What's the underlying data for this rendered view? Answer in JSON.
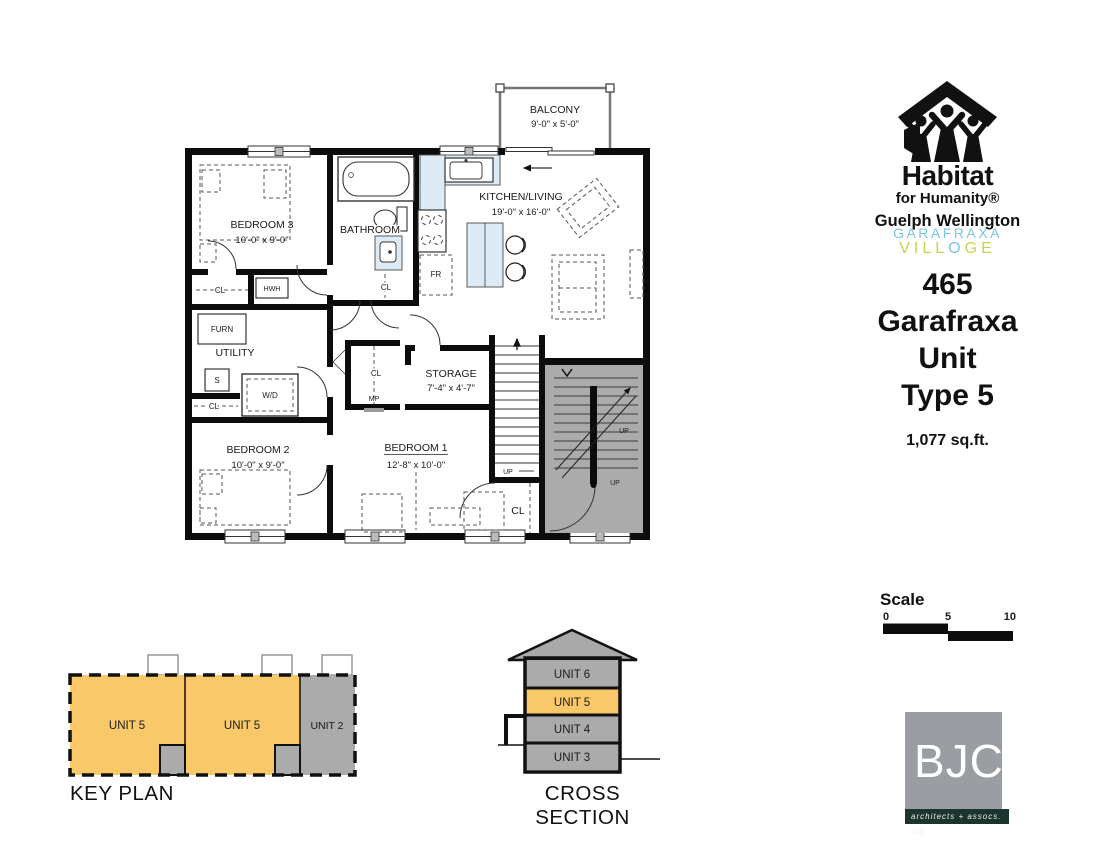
{
  "plan": {
    "balcony": {
      "name": "BALCONY",
      "dims": "9'-0\" x 5'-0\""
    },
    "kitchen": {
      "name": "KITCHEN/LIVING",
      "dims": "19'-0\" x 16'-0\""
    },
    "bathroom": {
      "name": "BATHROOM"
    },
    "bedroom3": {
      "name": "BEDROOM 3",
      "dims": "10'-0\" x 9'-0\""
    },
    "bedroom2": {
      "name": "BEDROOM 2",
      "dims": "10'-0\" x 9'-0\""
    },
    "bedroom1": {
      "name": "BEDROOM 1",
      "dims": "12'-8\" x 10'-0\""
    },
    "storage": {
      "name": "STORAGE",
      "dims": "7'-4\" x 4'-7\""
    },
    "utility": {
      "name": "UTILITY"
    },
    "labels": {
      "cl": "CL",
      "hwh": "HWH",
      "furn": "FURN",
      "s": "S",
      "wd": "W/D",
      "fr": "FR",
      "mp": "MP",
      "up": "UP"
    }
  },
  "branding": {
    "habitat": {
      "word": "Habitat",
      "sub": "for Humanity®",
      "region": "Guelph Wellington"
    },
    "village": {
      "line1": "GARAFRAXA",
      "l2a": "VILL",
      "l2o": "O",
      "l2b": "GE"
    }
  },
  "title": {
    "lines": [
      "465",
      "Garafraxa",
      "Unit",
      "Type 5"
    ],
    "area": "1,077 sq.ft."
  },
  "scale": {
    "label": "Scale",
    "t0": "0",
    "t5": "5",
    "t10": "10"
  },
  "key_plan": {
    "label": "KEY PLAN",
    "units": [
      "UNIT 5",
      "UNIT 5",
      "UNIT 2"
    ]
  },
  "cross_section": {
    "label": "CROSS SECTION",
    "units": [
      "UNIT 6",
      "UNIT 5",
      "UNIT 4",
      "UNIT 3"
    ]
  },
  "firm": {
    "name": "BJC",
    "tagline": "architects + assocs.  inc."
  },
  "colors": {
    "unit_orange": "#f9c869",
    "plan_gray": "#ababab",
    "counter_blue": "#dcebf5",
    "village_blue": "#7bc6e2",
    "village_green": "#c3d64f",
    "bjc_gray": "#9a9ea2",
    "bjc_bar": "#1c342e"
  }
}
